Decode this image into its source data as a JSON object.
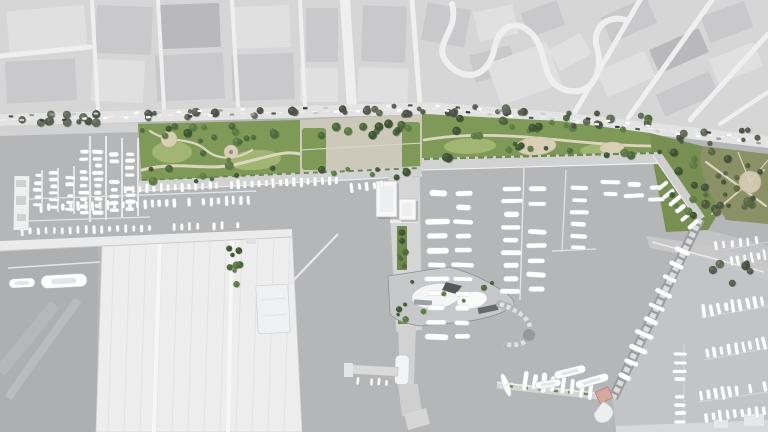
{
  "meta": {
    "title": "Port and waterfront masterplan - aerial site plan rendering",
    "width": 768,
    "height": 432
  },
  "palette": {
    "water": "#b4b6b8",
    "water_west": "#adafb1",
    "water_right": "#c2c4c5",
    "city_base": "#d6d6d6",
    "city_road": "#efefef",
    "city_block_dark": "#b9b9bb",
    "city_block_mid": "#c9c9cb",
    "city_block_light": "#e0e0e0",
    "boulevard": "#e3e3e3",
    "quay": "#d2d2d2",
    "pier": "#ededee",
    "terminal_stripe": "#e2e2e3",
    "park": "#7f9a58",
    "lawn": "#a2b573",
    "park_shade": "#5e7a42",
    "olive": "#8a9166",
    "path": "#dcd5bf",
    "plaza": "#ccc8ba",
    "plaza_circle": "#d8cfb4",
    "boat": "#ffffff",
    "breakwater": "#9b9da0",
    "roof_dark": "#56575b",
    "roof_red": "#8d5045",
    "bldg_white": "#f7f7f7",
    "bldg_pink": "#d7a8a0",
    "outline": "#96989a"
  },
  "features": [
    {
      "id": "city-context",
      "label": "existing city blocks (desaturated)"
    },
    {
      "id": "coastal-boulevard",
      "label": "coastal boulevard with parked cars and street trees"
    },
    {
      "id": "waterfront-park-west",
      "label": "western waterfront park with lawns, paths and plazas"
    },
    {
      "id": "central-plaza",
      "label": "central plaza with market hall and red-roof building"
    },
    {
      "id": "waterfront-park-east",
      "label": "eastern waterfront park band"
    },
    {
      "id": "hillside-park",
      "label": "olive park with circular plaza"
    },
    {
      "id": "west-marina-basin",
      "label": "west marina basin with finger piers and boats"
    },
    {
      "id": "west-terminal-pier",
      "label": "large white terminal pier with berth stripes"
    },
    {
      "id": "central-pier",
      "label": "central pier with harbor buildings and yacht club"
    },
    {
      "id": "east-marina-docks",
      "label": "east marina basin with yacht rows"
    },
    {
      "id": "main-breakwater",
      "label": "diagonal breakwater"
    },
    {
      "id": "south-pier",
      "label": "south pier with planters and pink pavilion"
    },
    {
      "id": "existing-marina-east",
      "label": "existing dense marina (grayscale)"
    }
  ],
  "decor": {
    "tree_clusters": [
      {
        "x": 140,
        "y": 126,
        "w": 156,
        "h": 16,
        "n": 15
      },
      {
        "x": 142,
        "y": 168,
        "w": 150,
        "h": 14,
        "n": 9
      },
      {
        "x": 196,
        "y": 140,
        "w": 64,
        "h": 26,
        "n": 6
      },
      {
        "x": 302,
        "y": 124,
        "w": 116,
        "h": 12,
        "n": 9
      },
      {
        "x": 302,
        "y": 168,
        "w": 116,
        "h": 10,
        "n": 7
      },
      {
        "x": 424,
        "y": 118,
        "w": 226,
        "h": 14,
        "n": 16
      },
      {
        "x": 424,
        "y": 148,
        "w": 220,
        "h": 12,
        "n": 10
      },
      {
        "x": 468,
        "y": 130,
        "w": 70,
        "h": 18,
        "n": 5
      },
      {
        "x": 650,
        "y": 140,
        "w": 64,
        "h": 78,
        "n": 13
      },
      {
        "x": 702,
        "y": 150,
        "w": 62,
        "h": 66,
        "n": 22,
        "kind": "olive"
      },
      {
        "x": 228,
        "y": 246,
        "w": 12,
        "h": 48,
        "n": 8,
        "r": 2.6
      },
      {
        "x": 397,
        "y": 226,
        "w": 10,
        "h": 42,
        "n": 6,
        "r": 2.2
      },
      {
        "x": 398,
        "y": 286,
        "w": 10,
        "h": 38,
        "n": 5,
        "r": 2.2
      },
      {
        "x": 4,
        "y": 114,
        "w": 130,
        "h": 10,
        "n": 12,
        "kind": "street"
      },
      {
        "x": 140,
        "y": 110,
        "w": 160,
        "h": 10,
        "n": 14,
        "kind": "street"
      },
      {
        "x": 300,
        "y": 105,
        "w": 130,
        "h": 10,
        "n": 11,
        "kind": "street"
      },
      {
        "x": 432,
        "y": 104,
        "w": 126,
        "h": 12,
        "n": 10,
        "kind": "street"
      },
      {
        "x": 560,
        "y": 113,
        "w": 110,
        "h": 14,
        "n": 9,
        "kind": "street"
      },
      {
        "x": 672,
        "y": 128,
        "w": 96,
        "h": 16,
        "n": 8,
        "kind": "street"
      },
      {
        "x": 412,
        "y": 276,
        "w": 96,
        "h": 42,
        "n": 6,
        "r": 2.4
      },
      {
        "x": 352,
        "y": 120,
        "w": 60,
        "h": 12,
        "n": 5
      },
      {
        "x": 700,
        "y": 255,
        "w": 60,
        "h": 30,
        "n": 6,
        "kind": "street"
      }
    ],
    "boat_rows": [
      {
        "x1": 115,
        "y1": 190,
        "x2": 340,
        "y2": 180,
        "n": 32,
        "bl": 8,
        "bw": 3.4
      },
      {
        "x1": 30,
        "y1": 208,
        "x2": 252,
        "y2": 200,
        "n": 30,
        "bl": 8,
        "bw": 3.4
      },
      {
        "x1": 10,
        "y1": 232,
        "x2": 250,
        "y2": 225,
        "n": 30,
        "bl": 7,
        "bw": 3
      },
      {
        "x1": 84,
        "y1": 142,
        "x2": 84,
        "y2": 216,
        "n": 11,
        "bl": 9,
        "bw": 4
      },
      {
        "x1": 98,
        "y1": 142,
        "x2": 98,
        "y2": 216,
        "n": 11,
        "bl": 9,
        "bw": 4
      },
      {
        "x1": 114,
        "y1": 144,
        "x2": 114,
        "y2": 214,
        "n": 10,
        "bl": 9,
        "bw": 4
      },
      {
        "x1": 130,
        "y1": 144,
        "x2": 130,
        "y2": 212,
        "n": 10,
        "bl": 9,
        "bw": 4
      },
      {
        "x1": 70,
        "y1": 168,
        "x2": 70,
        "y2": 212,
        "n": 7,
        "bl": 8,
        "bw": 3.6
      },
      {
        "x1": 54,
        "y1": 170,
        "x2": 54,
        "y2": 210,
        "n": 6,
        "bl": 8,
        "bw": 3.6
      },
      {
        "x1": 38,
        "y1": 172,
        "x2": 38,
        "y2": 208,
        "n": 5,
        "bl": 8,
        "bw": 3.6
      },
      {
        "x1": 438,
        "y1": 186,
        "x2": 436,
        "y2": 344,
        "n": 11,
        "bl": 20,
        "bw": 5.5
      },
      {
        "x1": 464,
        "y1": 186,
        "x2": 462,
        "y2": 344,
        "n": 11,
        "bl": 18,
        "bw": 5
      },
      {
        "x1": 512,
        "y1": 182,
        "x2": 510,
        "y2": 298,
        "n": 9,
        "bl": 18,
        "bw": 5
      },
      {
        "x1": 538,
        "y1": 182,
        "x2": 536,
        "y2": 296,
        "n": 8,
        "bl": 16,
        "bw": 4.6
      },
      {
        "x1": 580,
        "y1": 182,
        "x2": 578,
        "y2": 254,
        "n": 6,
        "bl": 15,
        "bw": 4.4
      },
      {
        "x1": 610,
        "y1": 176,
        "x2": 610,
        "y2": 200,
        "n": 2,
        "bl": 16,
        "bw": 4.6
      },
      {
        "x1": 634,
        "y1": 178,
        "x2": 634,
        "y2": 202,
        "n": 2,
        "bl": 16,
        "bw": 4.6
      },
      {
        "x1": 656,
        "y1": 182,
        "x2": 656,
        "y2": 206,
        "n": 2,
        "bl": 14,
        "bw": 4.2
      },
      {
        "x1": 660,
        "y1": 182,
        "x2": 696,
        "y2": 228,
        "n": 6,
        "bl": 13,
        "bw": 4.2
      },
      {
        "x1": 686,
        "y1": 244,
        "x2": 622,
        "y2": 384,
        "n": 10,
        "bl": 16,
        "bw": 4.6
      },
      {
        "x1": 520,
        "y1": 380,
        "x2": 596,
        "y2": 390,
        "n": 8,
        "bl": 18,
        "bw": 4.6
      },
      {
        "x1": 354,
        "y1": 380,
        "x2": 390,
        "y2": 383,
        "n": 5,
        "bl": 6.5,
        "bw": 2.8
      },
      {
        "x1": 700,
        "y1": 312,
        "x2": 766,
        "y2": 300,
        "n": 9,
        "bl": 11,
        "bw": 3.6
      },
      {
        "x1": 704,
        "y1": 354,
        "x2": 768,
        "y2": 342,
        "n": 9,
        "bl": 11,
        "bw": 3.6
      },
      {
        "x1": 698,
        "y1": 396,
        "x2": 768,
        "y2": 386,
        "n": 10,
        "bl": 11,
        "bw": 3.6
      },
      {
        "x1": 702,
        "y1": 418,
        "x2": 768,
        "y2": 410,
        "n": 9,
        "bl": 10,
        "bw": 3.4
      },
      {
        "x1": 728,
        "y1": 262,
        "x2": 768,
        "y2": 254,
        "n": 6,
        "bl": 9,
        "bw": 3.2
      },
      {
        "x1": 680,
        "y1": 350,
        "x2": 680,
        "y2": 426,
        "n": 9,
        "bl": 12,
        "bw": 3.8
      },
      {
        "x1": 712,
        "y1": 246,
        "x2": 760,
        "y2": 240,
        "n": 6,
        "bl": 8,
        "bw": 3
      },
      {
        "x1": 348,
        "y1": 188,
        "x2": 386,
        "y2": 184,
        "n": 5,
        "bl": 8,
        "bw": 3.4
      }
    ],
    "yachts": [
      {
        "x": 64,
        "y": 281,
        "l": 46,
        "w": 13,
        "rot": -3
      },
      {
        "x": 22,
        "y": 283,
        "l": 26,
        "w": 9,
        "rot": -3
      },
      {
        "x": 570,
        "y": 372,
        "l": 32,
        "w": 8,
        "rot": -14
      },
      {
        "x": 592,
        "y": 381,
        "l": 34,
        "w": 8,
        "rot": -16
      },
      {
        "x": 548,
        "y": 384,
        "l": 26,
        "w": 7,
        "rot": -8
      }
    ],
    "car_strips": [
      {
        "x1": 6,
        "y1": 118.5,
        "x2": 426,
        "y2": 107.5,
        "n": 40
      },
      {
        "x1": 432,
        "y1": 107.5,
        "x2": 558,
        "y2": 117,
        "n": 12
      },
      {
        "x1": 562,
        "y1": 118,
        "x2": 764,
        "y2": 141,
        "n": 20
      }
    ],
    "terminal_stripes": {
      "x_start": 114,
      "x_end": 290,
      "step": 16,
      "top_y1": 245,
      "top_y2": 234,
      "bottom": 432,
      "lean": -6
    }
  }
}
